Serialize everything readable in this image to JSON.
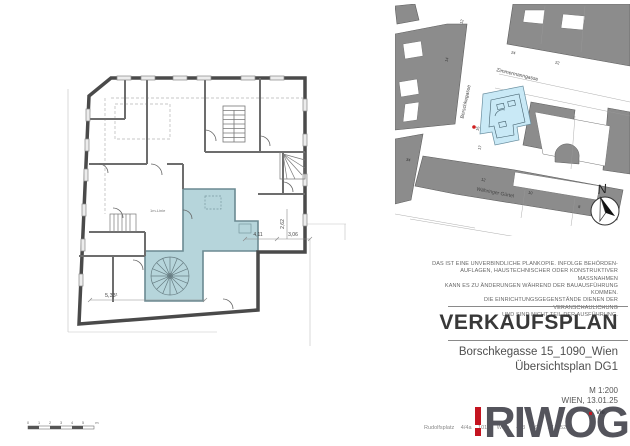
{
  "title_block": {
    "disclaimer_lines": [
      "DAS IST EINE UNVERBINDLICHE PLANKOPIE. INFOLGE BEHÖRDEN-",
      "AUFLAGEN, HAUSTECHNISCHER ODER KONSTRUKTIVER MASSNAHMEN",
      "KANN ES ZU ÄNDERUNGEN WÄHREND DER BAUAUSFÜHRUNG KOMMEN.",
      "DIE EINRICHTUNGSGEGENSTÄNDE DIENEN DER VERANSCHAULICHUNG",
      "UND SIND NICHT TEIL DER AUSFÜHRUNG."
    ],
    "title": "VERKAUFSPLAN",
    "address": "Borschkegasse 15_1090_Wien",
    "plan_name": "Übersichtsplan DG1",
    "scale": "M 1:200",
    "city_date": "WIEN, 13.01.25",
    "logo": {
      "text": "RIWOG",
      "accent": "#c41420",
      "gray": "#54545c",
      "fragment": "Vie"
    },
    "footer_address": "Rudolfsplatz 4/4a  1010 Wien  +43 699 17 520"
  },
  "floor_plan": {
    "highlight_color": "#b6d5db",
    "wall_color": "#4a4a4a",
    "room_label": "1m-Linie",
    "dim_labels": [
      "5,33¹",
      "4,11",
      "3,06",
      "2,62"
    ],
    "scale_bar": {
      "ticks": [
        "0",
        "1",
        "2",
        "3",
        "4",
        "5"
      ],
      "unit": "m"
    }
  },
  "site_plan": {
    "streets": [
      "Borschkegasse",
      "Zimmermanngasse",
      "Währinger Gürtel"
    ],
    "parcels": [
      "12",
      "14",
      "24",
      "22",
      "34",
      "15",
      "17",
      "12",
      "10",
      "8"
    ],
    "highlight_color": "#c9e9f6",
    "building_color": "#8c8c8c",
    "marker_color": "#d01f1f",
    "north_label": "N"
  }
}
